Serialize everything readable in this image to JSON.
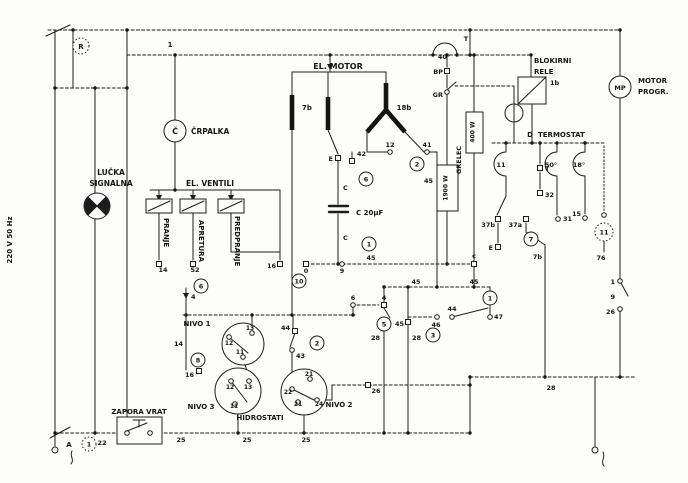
{
  "sch": {
    "supply_note": "220 V 50 Hz",
    "switch_r": "R",
    "line1": "1",
    "pump": {
      "sym": "Č",
      "name": "ČRPALKA"
    },
    "lamp": {
      "l1": "LUČKA",
      "l2": "SIGNALNA"
    },
    "valves": {
      "name": "EL. VENTILI",
      "v1": "PRANJE",
      "v2": "APRETURA",
      "v3": "PREDPRANJE"
    },
    "motor": {
      "name": "EL. MOTOR",
      "w1": "7b",
      "w2": "18b"
    },
    "cap": {
      "name": "C 20µF",
      "c1": "C",
      "c2": "C"
    },
    "heater": {
      "name": "GRELEC",
      "p1": "1900 W",
      "p2": "400 W"
    },
    "relay": {
      "l1": "BLOKIRNI",
      "l2": "RELE",
      "code": "1b"
    },
    "thermo": {
      "prefix": "D",
      "name": "TERMOSTAT",
      "t40": "40°",
      "t50": "50°",
      "t18": "18°",
      "arc_left": "11"
    },
    "mp": {
      "sym": "MP",
      "l1": "MOTOR",
      "l2": "PROGR."
    },
    "hydro": {
      "n1": "NIVO 1",
      "n2": "NIVO 2",
      "n3": "NIVO 3",
      "name": "HIDROSTATI"
    },
    "door": {
      "name": "ZAPORA VRAT",
      "a": "A"
    }
  },
  "t": {
    "T1": "T",
    "BP": "BP",
    "GR": "GR",
    "m12": "12",
    "m41": "41",
    "E1": "E",
    "c42": "42",
    "v45a": "45",
    "v45b": "45",
    "z0": "0",
    "n9": "9",
    "lc": "c",
    "v14a": "14",
    "v52": "52",
    "v16a": "16",
    "v4a": "4",
    "T2": "T",
    "t32": "32",
    "t37b": "37b",
    "t37a": "37a",
    "E2": "E",
    "t7b": "7b",
    "t31": "31",
    "t15": "15",
    "t76": "76",
    "mp1": "1",
    "mp9": "9",
    "mp26": "26",
    "t28a": "28",
    "t14b": "14",
    "t16b": "16",
    "t44a": "44",
    "t43": "43",
    "n1_12": "12",
    "n1_13": "13",
    "n1_11": "11",
    "n3_12": "12",
    "n3_13": "13",
    "n3_11": "11",
    "n2_21a": "21",
    "n2_22": "22",
    "n2_21b": "21",
    "n2_24": "24",
    "t26b": "26",
    "t25a": "25",
    "t25b": "25",
    "t25c": "25",
    "t22": "22",
    "v45c": "45",
    "v45d": "45",
    "v45e": "45",
    "t4b": "4",
    "t6b": "6",
    "t46": "46",
    "t44b": "44",
    "t47": "47",
    "t28b": "28",
    "t28c": "28"
  },
  "m": {
    "m6a": "6",
    "m6b": "6",
    "m1a": "1",
    "m1b": "1",
    "m1c": "1",
    "m2a": "2",
    "m2b": "2",
    "m3": "3",
    "m5": "5",
    "m7": "7",
    "m8": "8",
    "m10": "10",
    "m11": "11"
  }
}
